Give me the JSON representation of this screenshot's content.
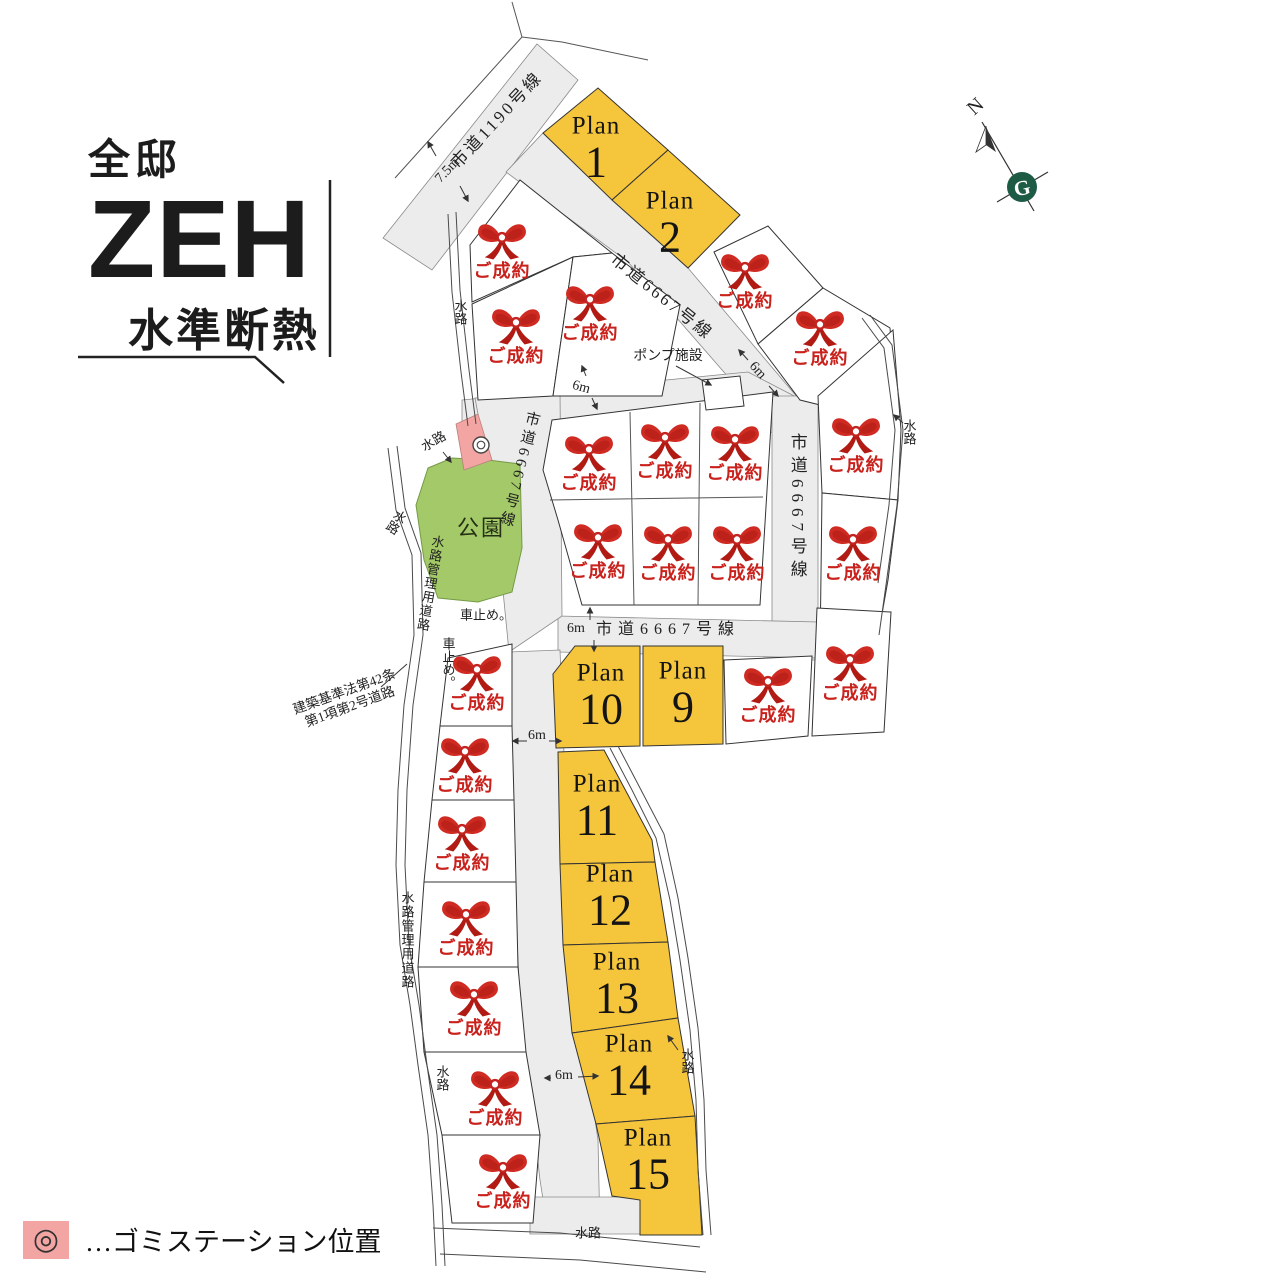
{
  "badge": {
    "line1": "全邸",
    "line2": "ZEH",
    "line3": "水準断熱"
  },
  "compass": {
    "north": "N",
    "logo_letter": "G"
  },
  "legend": {
    "symbol": "◎",
    "label": "…ゴミステーション位置"
  },
  "park": {
    "label": "公園"
  },
  "pump": {
    "label": "ポンプ施設"
  },
  "sold": {
    "label": "ご成約"
  },
  "plans": {
    "prefix": "Plan",
    "numbers": [
      "1",
      "2",
      "9",
      "10",
      "11",
      "12",
      "13",
      "14",
      "15"
    ]
  },
  "roads": {
    "route1190": "市道1190号線",
    "route6667": "市道6667号線",
    "building_std_1": "建築基準法第42条",
    "building_std_2": "第1項第2号道路",
    "waterway_mgmt": "水路管理用道路",
    "waterway": "水路",
    "car_stop": "車止め。"
  },
  "dims": {
    "w75": "7.5m",
    "w6": "6m"
  },
  "colors": {
    "lot_yellow": "#f5c53c",
    "park_green": "#a3c968",
    "road_gray": "#ececec",
    "sold_red": "#c9211c",
    "pink": "#f2a5a3",
    "logo_green": "#1e5b45"
  }
}
